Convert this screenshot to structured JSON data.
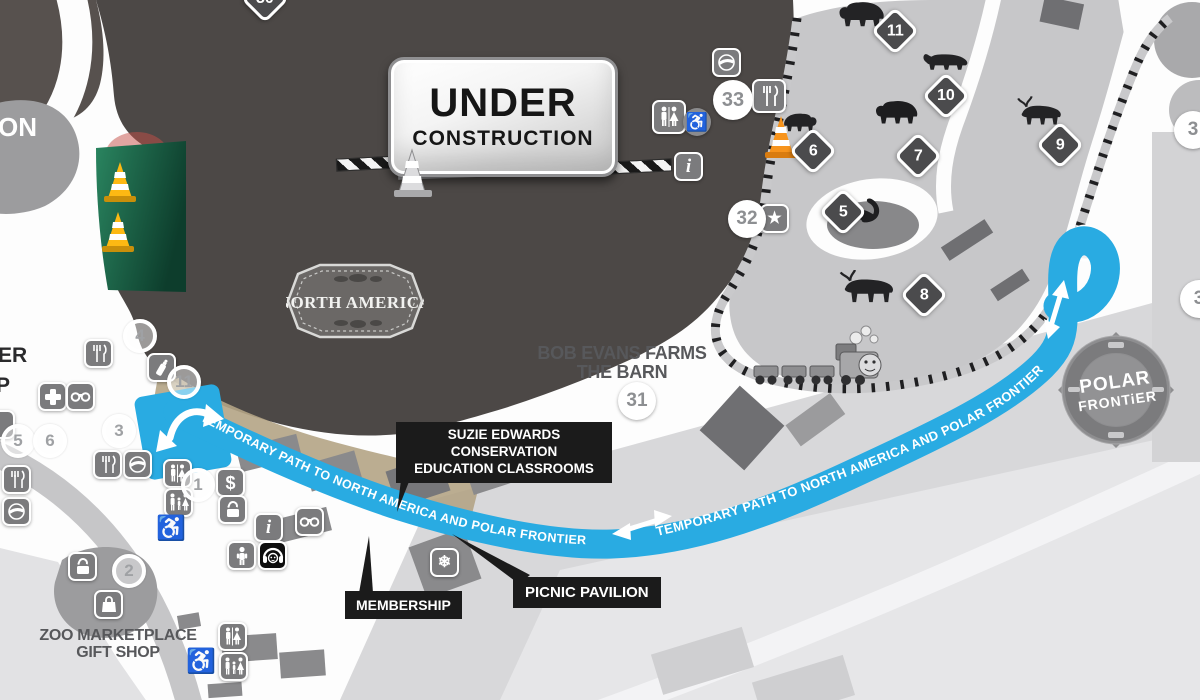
{
  "map": {
    "sign": {
      "line1": "UNDER",
      "line2": "CONSTRUCTION"
    },
    "badges": {
      "north_america": "North America",
      "polar_line1": "POLAR",
      "polar_line2": "FRONTiER"
    },
    "path_label_left": "TEMPORARY PATH TO NORTH AMERICA AND POLAR FRONTIER",
    "path_label_right": "TEMPORARY PATH TO NORTH AMERICA AND POLAR FRONTIER",
    "colors": {
      "temporary_path_blue": "#29abe2",
      "construction_zone": "#4c4846",
      "habitat_gray": "#c7c7c9",
      "label_black": "#1b1b1b",
      "cone_orange": "#f7941d",
      "cone_yellow": "#fdb913",
      "grass_green": "#1d6b4c"
    }
  },
  "labels": {
    "suzie_line1": "SUZIE EDWARDS CONSERVATION",
    "suzie_line2": "EDUCATION CLASSROOMS",
    "membership": "MEMBERSHIP",
    "picnic": "PICNIC PAVILION",
    "bob_evans_line1": "BOB EVANS FARMS",
    "bob_evans_line2": "THE BARN",
    "gift_shop_line1": "ZOO MARKETPLACE",
    "gift_shop_line2": "GIFT SHOP",
    "edge_on": "ON",
    "edge_per": "PER",
    "edge_p": "P"
  },
  "markers": {
    "diamonds": [
      {
        "n": "30"
      },
      {
        "n": "11"
      },
      {
        "n": "10"
      },
      {
        "n": "7"
      },
      {
        "n": "6"
      },
      {
        "n": "9"
      },
      {
        "n": "5"
      },
      {
        "n": "8"
      }
    ],
    "circles": [
      {
        "n": "33"
      },
      {
        "n": "32"
      },
      {
        "n": "31"
      },
      {
        "n": "4"
      },
      {
        "n": "11"
      },
      {
        "n": "3"
      },
      {
        "n": "5"
      },
      {
        "n": "6"
      },
      {
        "n": "1"
      },
      {
        "n": "2"
      },
      {
        "n": "30"
      },
      {
        "n": "3"
      },
      {
        "n": "3"
      }
    ]
  },
  "icons": {
    "star": "★",
    "snowflake": "❄",
    "wheelchair": "♿",
    "dollar": "$",
    "info": "i",
    "names": [
      "pepsi-icon",
      "food-icon",
      "restroom-icon",
      "family-restroom-icon",
      "info-icon",
      "star-icon",
      "first-aid-icon",
      "binoculars-icon",
      "dollar-icon",
      "locker-icon",
      "baby-care-icon",
      "child-icon",
      "audio-tour-icon",
      "gift-bag-icon",
      "snowflake-icon",
      "accessible-icon",
      "traffic-cone-icon",
      "train-icon"
    ]
  },
  "animals": [
    "bear",
    "wolverine",
    "black-bear",
    "bear-cub",
    "swan",
    "moose",
    "caribou"
  ]
}
